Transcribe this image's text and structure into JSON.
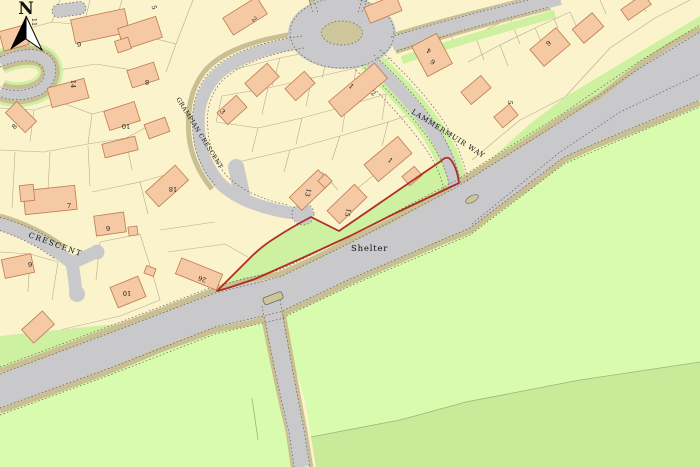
{
  "map": {
    "compass": {
      "label": "N"
    },
    "streets": [
      {
        "name": "GRAMPIAN CRESCENT"
      },
      {
        "name": "LAMMERMUIR WAY"
      },
      {
        "name": "CRESCENT"
      }
    ],
    "pois": [
      {
        "name": "Shelter"
      }
    ],
    "house_numbers": [
      {
        "text": "11"
      },
      {
        "text": "5"
      },
      {
        "text": "2"
      },
      {
        "text": "6"
      },
      {
        "text": "8"
      },
      {
        "text": "14"
      },
      {
        "text": "4"
      },
      {
        "text": "6"
      },
      {
        "text": "9"
      },
      {
        "text": "1"
      },
      {
        "text": "2"
      },
      {
        "text": "3"
      },
      {
        "text": "5"
      },
      {
        "text": "10"
      },
      {
        "text": "8"
      },
      {
        "text": "1"
      },
      {
        "text": "18"
      },
      {
        "text": "13"
      },
      {
        "text": "7"
      },
      {
        "text": "15"
      },
      {
        "text": "9"
      },
      {
        "text": "9"
      },
      {
        "text": "26"
      },
      {
        "text": "10"
      }
    ],
    "colors": {
      "paper": "#fbf3cc",
      "road": "#c9c9cb",
      "verge": "#c9bf93",
      "green_strip": "#cdf0a1",
      "field_light": "#d8fbae",
      "field_dark": "#c9ea99",
      "island": "#cec69b",
      "building": "#f4c9a4",
      "building_outline": "#bf7a4e",
      "edge_dash": "#63625a",
      "parcel_line": "#b3a88c",
      "boundary": "#ae2f24",
      "label": "#111111"
    }
  }
}
